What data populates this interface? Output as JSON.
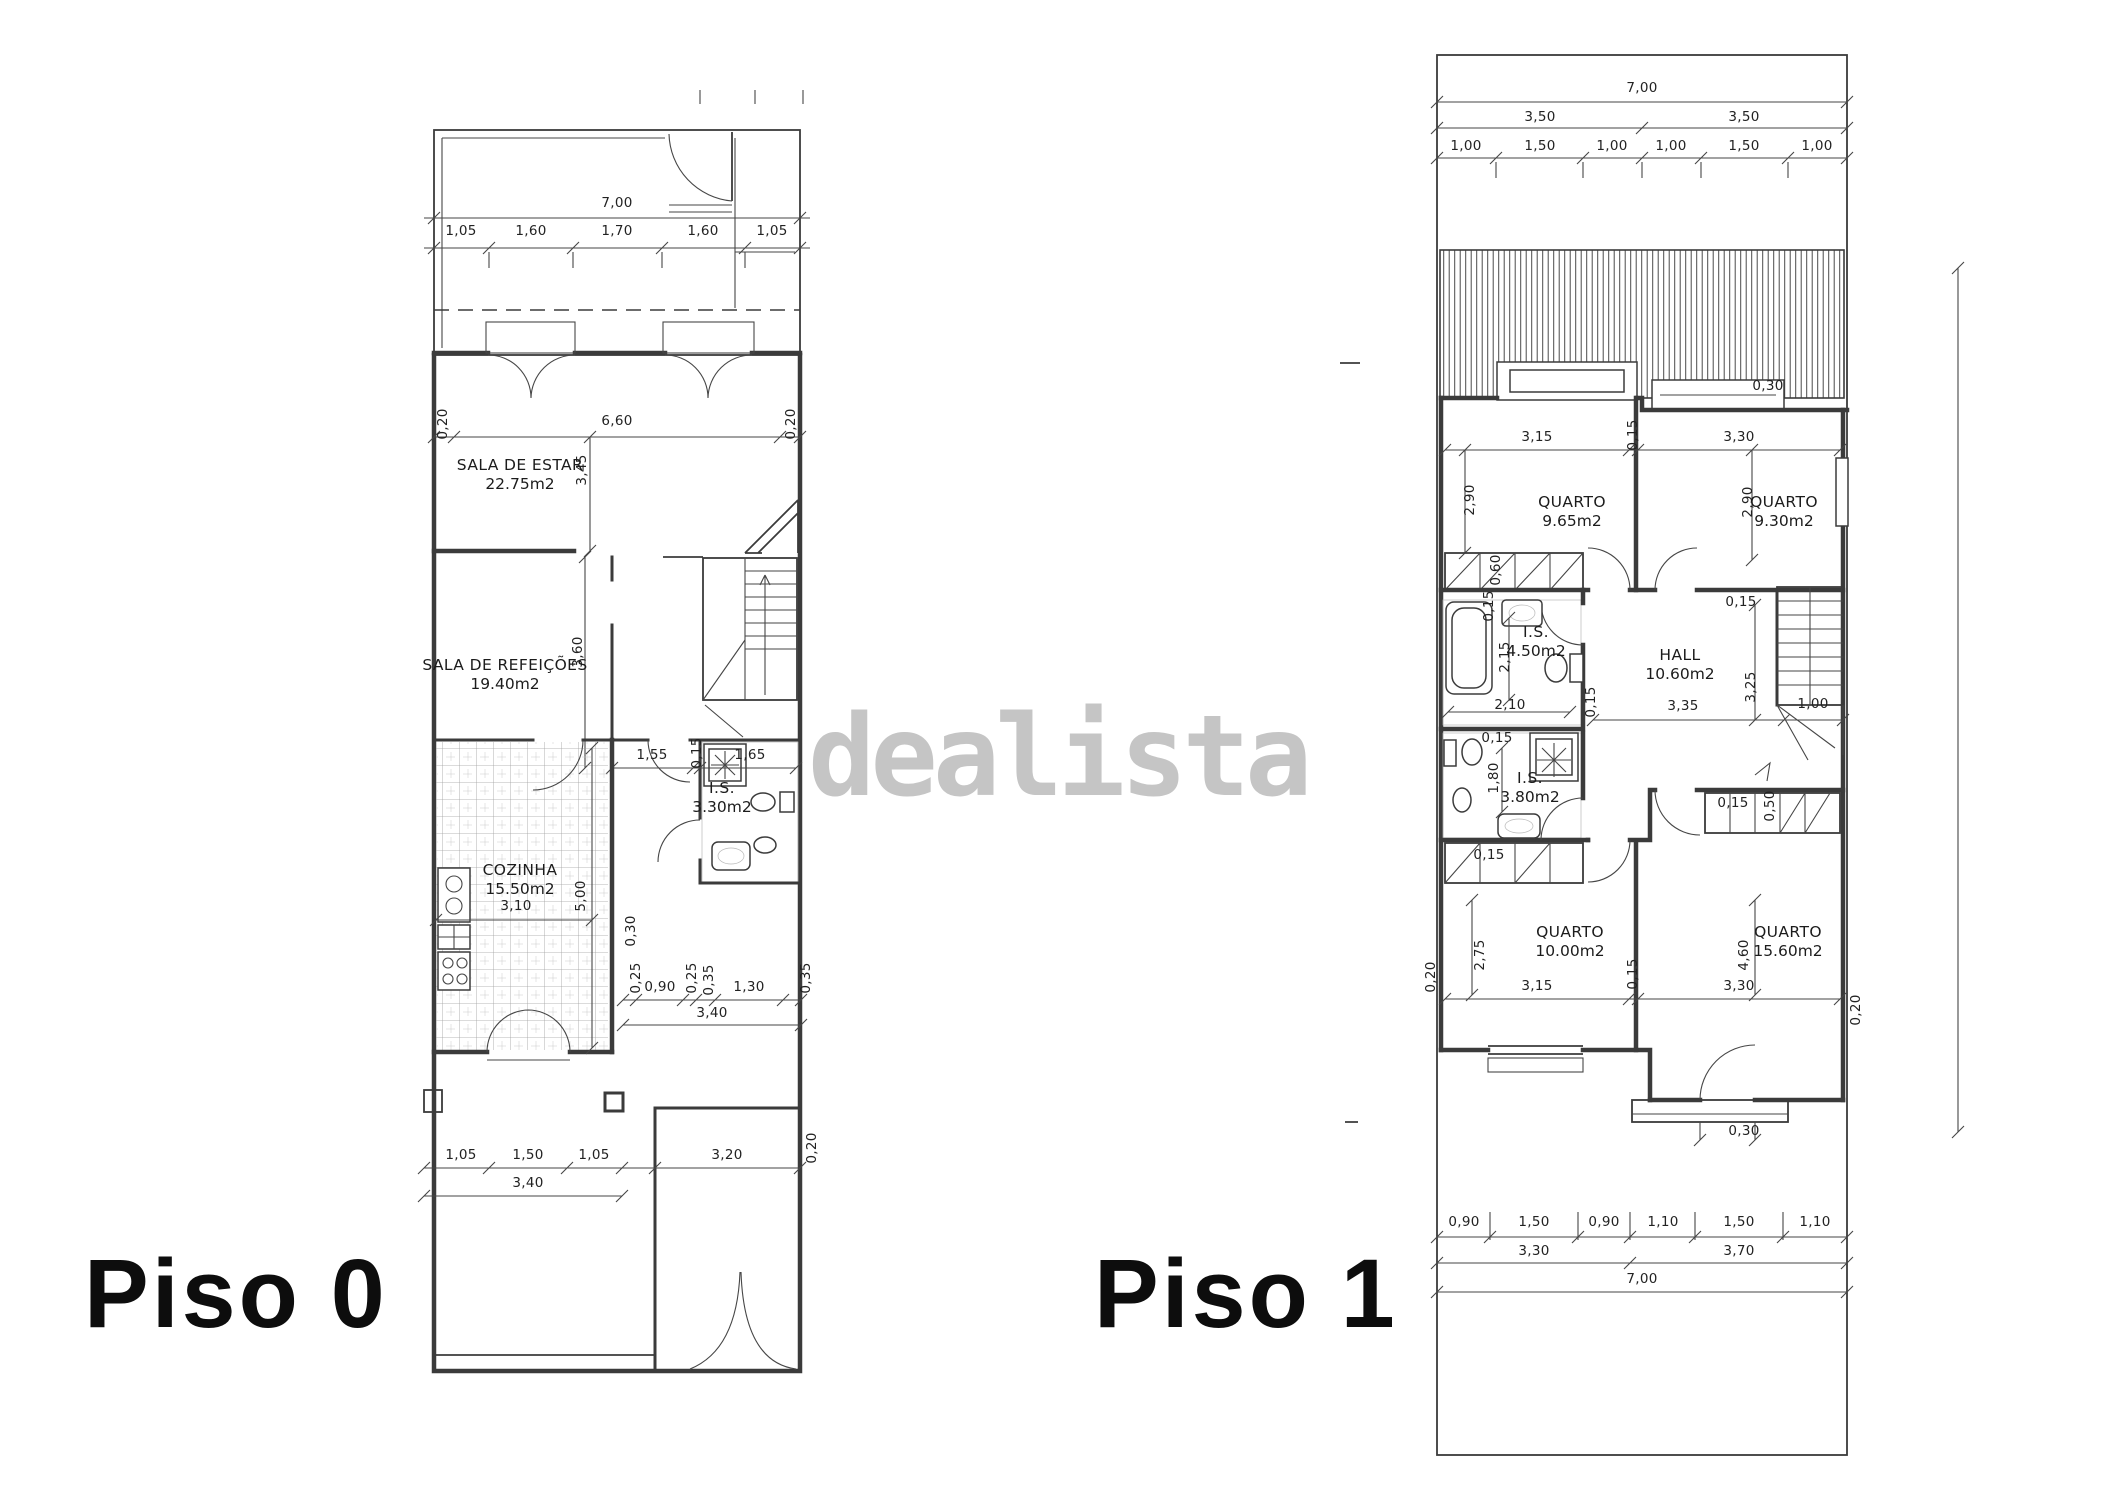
{
  "colors": {
    "line": "#3b3b3b",
    "watermark": "#c5c5c5",
    "text": "#1c1c1c",
    "background": "#ffffff"
  },
  "watermark": {
    "text": "dealista"
  },
  "floor0": {
    "label": "Piso 0",
    "rooms": [
      {
        "name": "SALA DE ESTAR",
        "area": "22.75m2",
        "x": 520,
        "y": 455
      },
      {
        "name": "SALA DE REFEIÇÕES",
        "area": "19.40m2",
        "x": 505,
        "y": 655
      },
      {
        "name": "COZINHA",
        "area": "15.50m2",
        "x": 520,
        "y": 860
      },
      {
        "name": "I.S.",
        "area": "3.30m2",
        "x": 722,
        "y": 778
      }
    ],
    "dims": [
      {
        "t": "7,00",
        "x": 617,
        "y": 203
      },
      {
        "t": "1,05",
        "x": 461,
        "y": 231
      },
      {
        "t": "1,60",
        "x": 531,
        "y": 231
      },
      {
        "t": "1,70",
        "x": 617,
        "y": 231
      },
      {
        "t": "1,60",
        "x": 703,
        "y": 231
      },
      {
        "t": "1,05",
        "x": 772,
        "y": 231
      },
      {
        "t": "6,60",
        "x": 617,
        "y": 421
      },
      {
        "t": "0,20",
        "x": 443,
        "y": 424,
        "r": 1
      },
      {
        "t": "0,20",
        "x": 791,
        "y": 424,
        "r": 1
      },
      {
        "t": "3,45",
        "x": 582,
        "y": 470,
        "r": 1
      },
      {
        "t": "3,60",
        "x": 578,
        "y": 652,
        "r": 1
      },
      {
        "t": "1,55",
        "x": 652,
        "y": 755
      },
      {
        "t": "0,15",
        "x": 697,
        "y": 753,
        "r": 1
      },
      {
        "t": "1,65",
        "x": 750,
        "y": 755
      },
      {
        "t": "3,10",
        "x": 516,
        "y": 906
      },
      {
        "t": "5,00",
        "x": 581,
        "y": 896,
        "r": 1
      },
      {
        "t": "0,30",
        "x": 631,
        "y": 931,
        "r": 1
      },
      {
        "t": "0,25",
        "x": 636,
        "y": 978,
        "r": 1
      },
      {
        "t": "0,90",
        "x": 660,
        "y": 987
      },
      {
        "t": "0,25",
        "x": 692,
        "y": 978,
        "r": 1
      },
      {
        "t": "0,35",
        "x": 709,
        "y": 980,
        "r": 1
      },
      {
        "t": "1,30",
        "x": 749,
        "y": 987
      },
      {
        "t": "0,35",
        "x": 806,
        "y": 978,
        "r": 1
      },
      {
        "t": "3,40",
        "x": 712,
        "y": 1013
      },
      {
        "t": "1,05",
        "x": 461,
        "y": 1155
      },
      {
        "t": "1,50",
        "x": 528,
        "y": 1155
      },
      {
        "t": "1,05",
        "x": 594,
        "y": 1155
      },
      {
        "t": "3,40",
        "x": 528,
        "y": 1183
      },
      {
        "t": "3,20",
        "x": 727,
        "y": 1155
      },
      {
        "t": "0,20",
        "x": 812,
        "y": 1148,
        "r": 1
      }
    ]
  },
  "floor1": {
    "label": "Piso 1",
    "rooms": [
      {
        "name": "QUARTO",
        "area": "9.65m2",
        "x": 1572,
        "y": 492
      },
      {
        "name": "QUARTO",
        "area": "9.30m2",
        "x": 1784,
        "y": 492
      },
      {
        "name": "I.S.",
        "area": "4.50m2",
        "x": 1536,
        "y": 622
      },
      {
        "name": "HALL",
        "area": "10.60m2",
        "x": 1680,
        "y": 645
      },
      {
        "name": "I.S.",
        "area": "3.80m2",
        "x": 1530,
        "y": 768
      },
      {
        "name": "QUARTO",
        "area": "10.00m2",
        "x": 1570,
        "y": 922
      },
      {
        "name": "QUARTO",
        "area": "15.60m2",
        "x": 1788,
        "y": 922
      }
    ],
    "dims": [
      {
        "t": "7,00",
        "x": 1642,
        "y": 88
      },
      {
        "t": "3,50",
        "x": 1540,
        "y": 117
      },
      {
        "t": "3,50",
        "x": 1744,
        "y": 117
      },
      {
        "t": "1,00",
        "x": 1466,
        "y": 146
      },
      {
        "t": "1,50",
        "x": 1540,
        "y": 146
      },
      {
        "t": "1,00",
        "x": 1612,
        "y": 146
      },
      {
        "t": "1,00",
        "x": 1671,
        "y": 146
      },
      {
        "t": "1,50",
        "x": 1744,
        "y": 146
      },
      {
        "t": "1,00",
        "x": 1817,
        "y": 146
      },
      {
        "t": "0,30",
        "x": 1768,
        "y": 386
      },
      {
        "t": "3,15",
        "x": 1537,
        "y": 437
      },
      {
        "t": "0,15",
        "x": 1633,
        "y": 435,
        "r": 1
      },
      {
        "t": "3,30",
        "x": 1739,
        "y": 437
      },
      {
        "t": "2,90",
        "x": 1470,
        "y": 500,
        "r": 1
      },
      {
        "t": "2,90",
        "x": 1748,
        "y": 502,
        "r": 1
      },
      {
        "t": "0,60",
        "x": 1496,
        "y": 570,
        "r": 1
      },
      {
        "t": "0,15",
        "x": 1489,
        "y": 606,
        "r": 1
      },
      {
        "t": "2,15",
        "x": 1505,
        "y": 657,
        "r": 1
      },
      {
        "t": "2,10",
        "x": 1510,
        "y": 705
      },
      {
        "t": "0,15",
        "x": 1591,
        "y": 702,
        "r": 1
      },
      {
        "t": "0,15",
        "x": 1741,
        "y": 602
      },
      {
        "t": "3,35",
        "x": 1683,
        "y": 706
      },
      {
        "t": "3,25",
        "x": 1751,
        "y": 687,
        "r": 1
      },
      {
        "t": "1,00",
        "x": 1813,
        "y": 704
      },
      {
        "t": "0,15",
        "x": 1497,
        "y": 738
      },
      {
        "t": "1,80",
        "x": 1494,
        "y": 778,
        "r": 1
      },
      {
        "t": "0,15",
        "x": 1733,
        "y": 803
      },
      {
        "t": "0,50",
        "x": 1770,
        "y": 806,
        "r": 1
      },
      {
        "t": "0,15",
        "x": 1489,
        "y": 855
      },
      {
        "t": "0,20",
        "x": 1431,
        "y": 977,
        "r": 1
      },
      {
        "t": "2,75",
        "x": 1480,
        "y": 955,
        "r": 1
      },
      {
        "t": "3,15",
        "x": 1537,
        "y": 986
      },
      {
        "t": "0,15",
        "x": 1633,
        "y": 974,
        "r": 1
      },
      {
        "t": "3,30",
        "x": 1739,
        "y": 986
      },
      {
        "t": "4,60",
        "x": 1744,
        "y": 955,
        "r": 1
      },
      {
        "t": "0,20",
        "x": 1856,
        "y": 1010,
        "r": 1
      },
      {
        "t": "0,30",
        "x": 1744,
        "y": 1131
      },
      {
        "t": "0,90",
        "x": 1464,
        "y": 1222
      },
      {
        "t": "1,50",
        "x": 1534,
        "y": 1222
      },
      {
        "t": "0,90",
        "x": 1604,
        "y": 1222
      },
      {
        "t": "1,10",
        "x": 1663,
        "y": 1222
      },
      {
        "t": "1,50",
        "x": 1739,
        "y": 1222
      },
      {
        "t": "1,10",
        "x": 1815,
        "y": 1222
      },
      {
        "t": "3,30",
        "x": 1534,
        "y": 1251
      },
      {
        "t": "3,70",
        "x": 1739,
        "y": 1251
      },
      {
        "t": "7,00",
        "x": 1642,
        "y": 1279
      }
    ]
  }
}
